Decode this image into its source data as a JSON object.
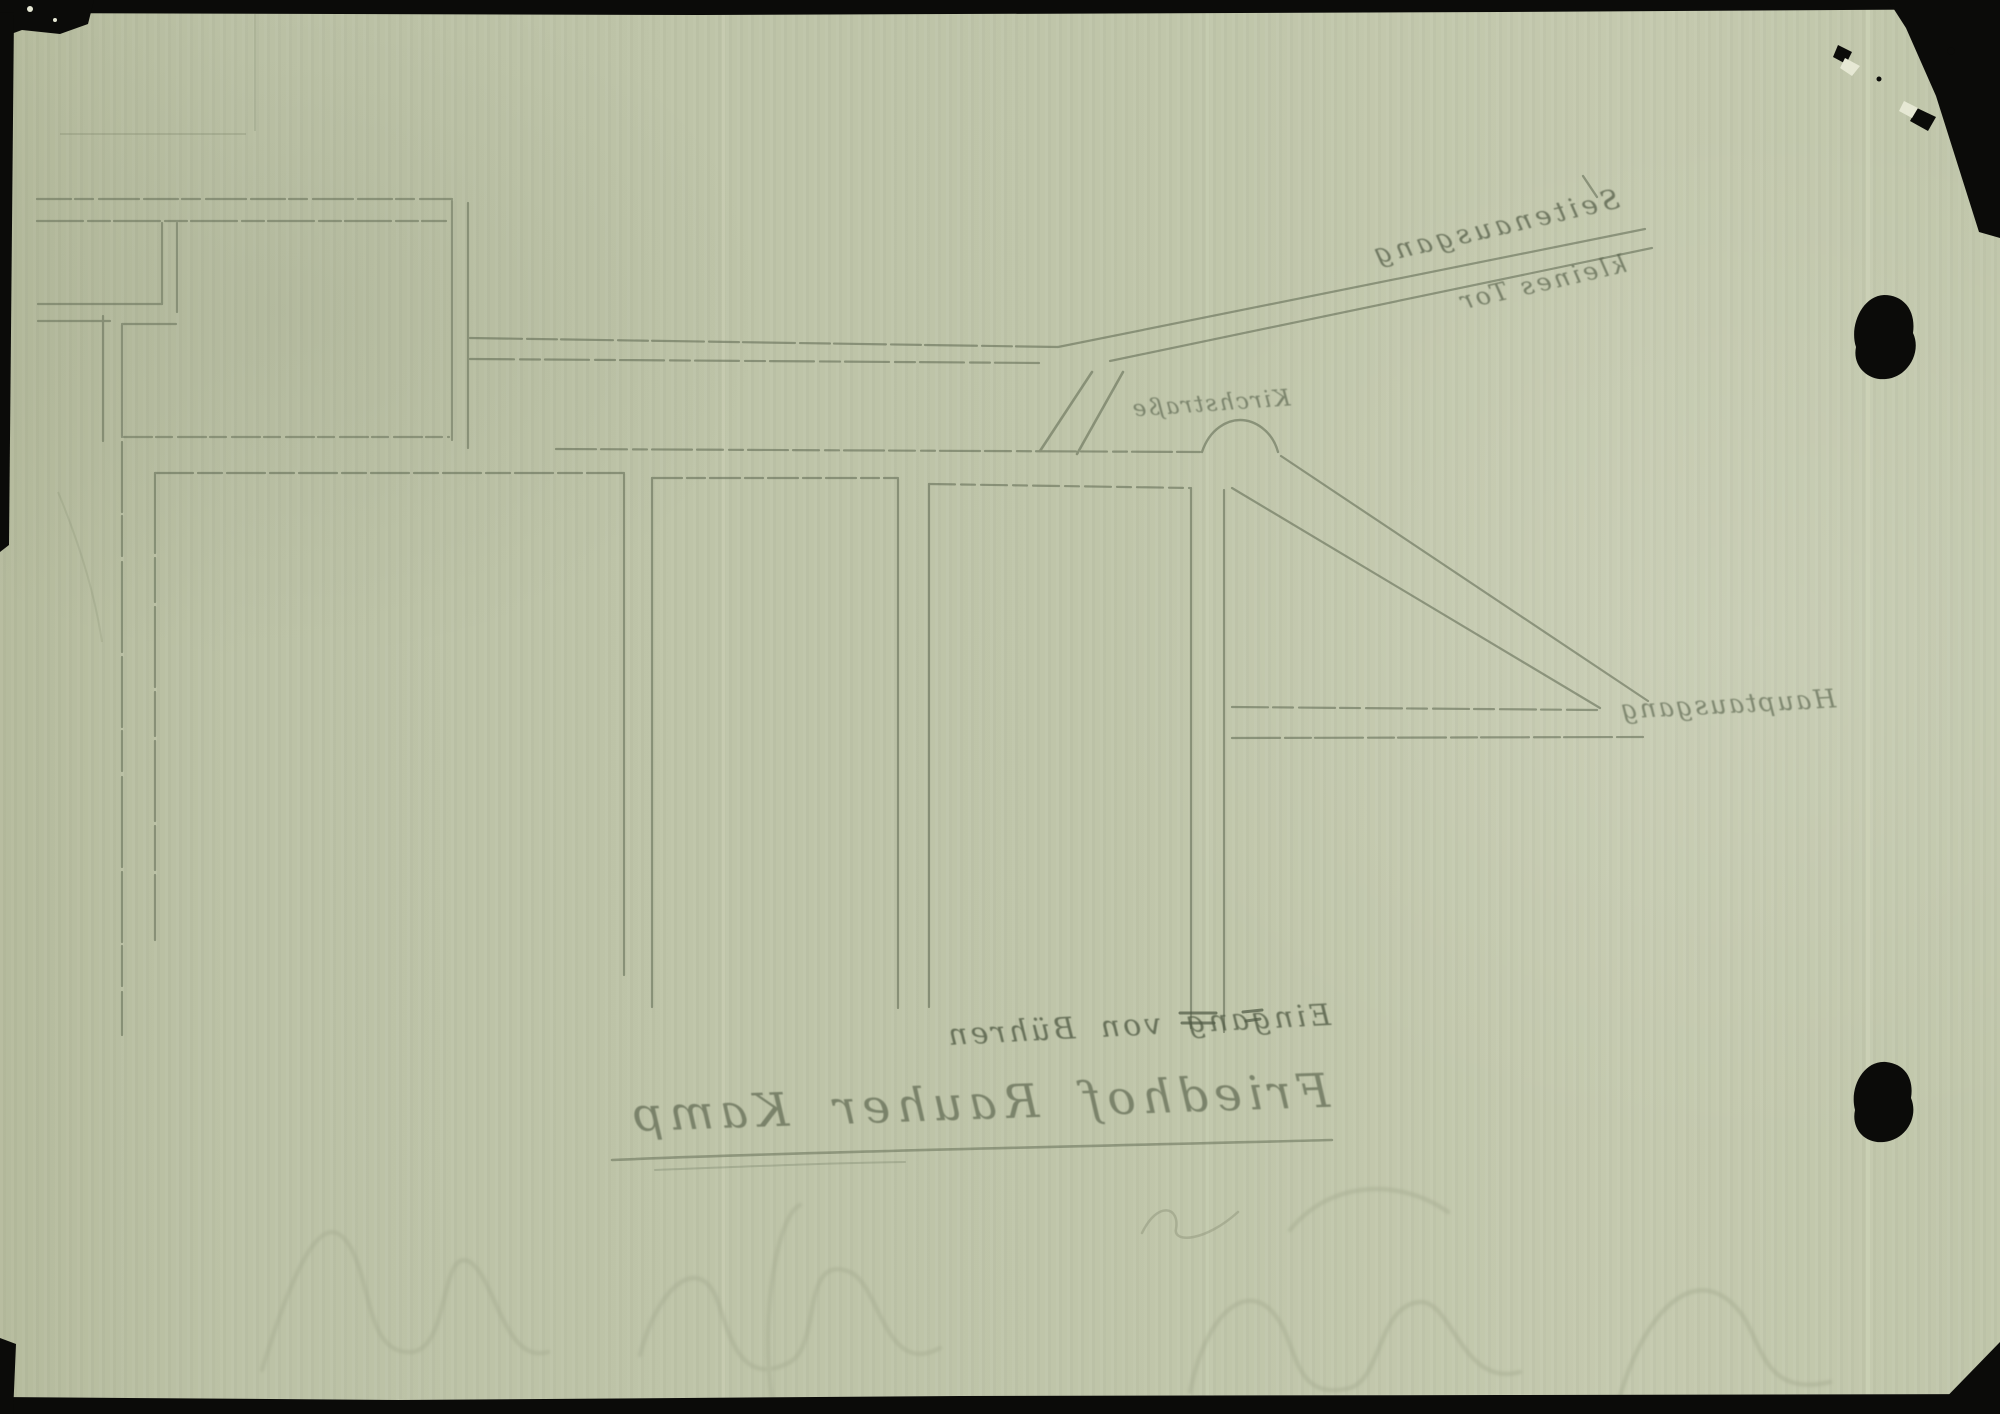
{
  "labels": {
    "title": "Friedhof Rauher Kamp",
    "side_exit": "Seitenausgang",
    "small_gate": "kleines Tor",
    "street": "Kirchstraße",
    "main_exit": "Hauptausgang",
    "entrance": "Eingang von Bühren"
  },
  "colors": {
    "paper": "#bdc3a7",
    "pencil": "#5d6750",
    "bleedthrough": "#a7ad92",
    "ink_black": "#0b0b09"
  }
}
